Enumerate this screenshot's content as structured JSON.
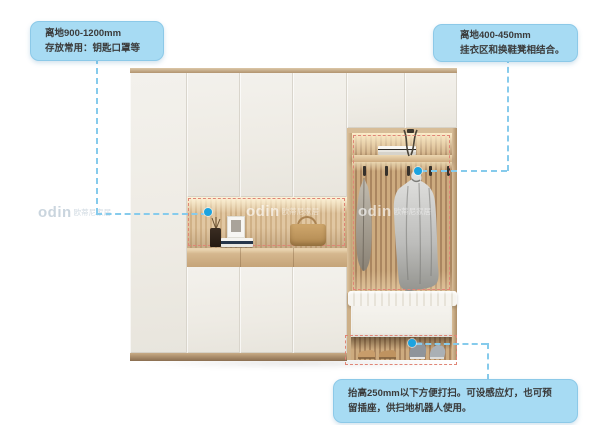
{
  "annotations": {
    "top_left": {
      "lines": [
        "离地900-1200mm",
        "存放常用：钥匙口罩等"
      ]
    },
    "top_right": {
      "lines": [
        "离地400-450mm",
        "挂衣区和换鞋凳相结合。"
      ]
    },
    "bottom": {
      "lines": [
        "抬高250mm以下方便打扫。可设感应灯，也可预",
        "留插座，供扫地机器人使用。"
      ]
    }
  },
  "watermark": {
    "brand": "odin",
    "suffix": "欧蒂尼家居"
  },
  "colors": {
    "callout_bg": "#a7dbf3",
    "callout_border": "#8cc9e8",
    "callout_text": "#3a3a3a",
    "leader": "#86cbec",
    "dot": "#1ba3e0",
    "highlight_red": "#e08576"
  }
}
